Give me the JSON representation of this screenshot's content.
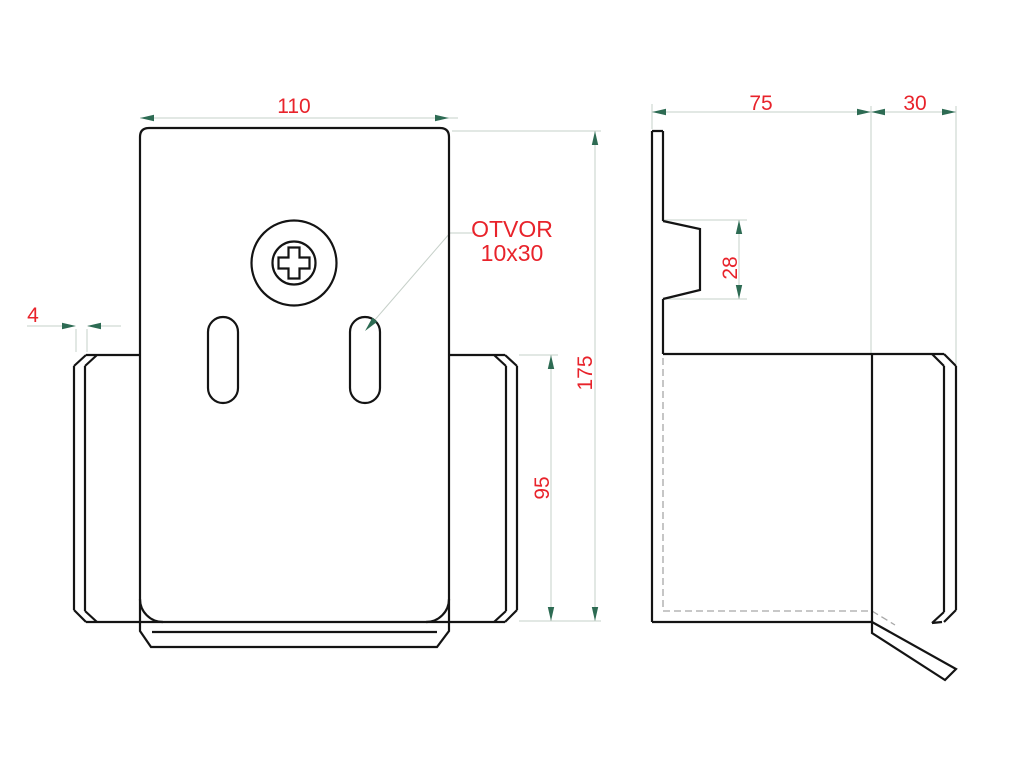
{
  "drawing": {
    "colors": {
      "outline": "#141414",
      "dimension_text": "#e8232b",
      "arrowhead": "#2d6b53",
      "dimension_line": "#c6d0c9",
      "hidden_line": "#a8a8a8",
      "background": "#ffffff"
    },
    "front_view": {
      "width": "110",
      "side_thickness": "4",
      "total_height": "175",
      "wing_height": "95",
      "hole_note_line1": "OTVOR",
      "hole_note_line2": "10x30"
    },
    "side_view": {
      "depth": "75",
      "flange_width": "30",
      "boss_height": "28"
    }
  }
}
